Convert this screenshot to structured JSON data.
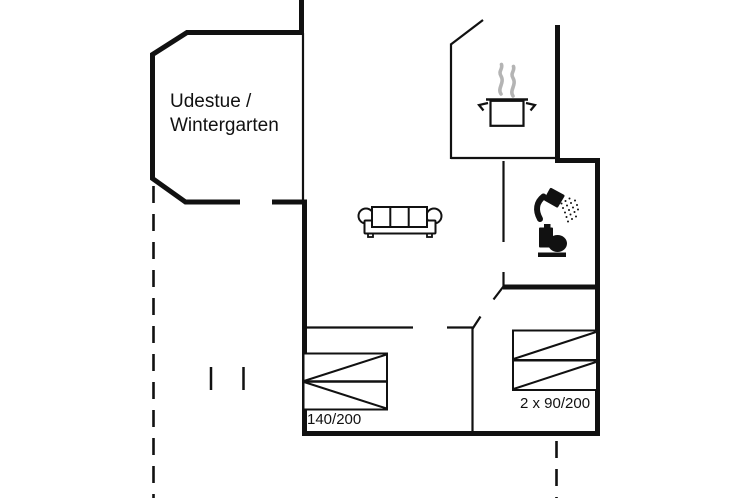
{
  "canvas": {
    "width": 754,
    "height": 498,
    "background": "#ffffff"
  },
  "floor_plan": {
    "rooms": {
      "conservatory": {
        "label_line1": "Udestue /",
        "label_line2": "Wintergarten"
      }
    },
    "beds": {
      "double": {
        "size_label": "140/200"
      },
      "twin": {
        "size_label": "2 x 90/200"
      }
    },
    "icons": [
      {
        "name": "sofa-icon"
      },
      {
        "name": "cooking-pot-icon"
      },
      {
        "name": "steam-icon"
      },
      {
        "name": "shower-icon"
      },
      {
        "name": "toilet-icon"
      },
      {
        "name": "double-bed-icon"
      },
      {
        "name": "twin-beds-icon"
      }
    ],
    "colors": {
      "wall": "#111111",
      "steam": "#b4b4b4",
      "background": "#ffffff"
    }
  }
}
